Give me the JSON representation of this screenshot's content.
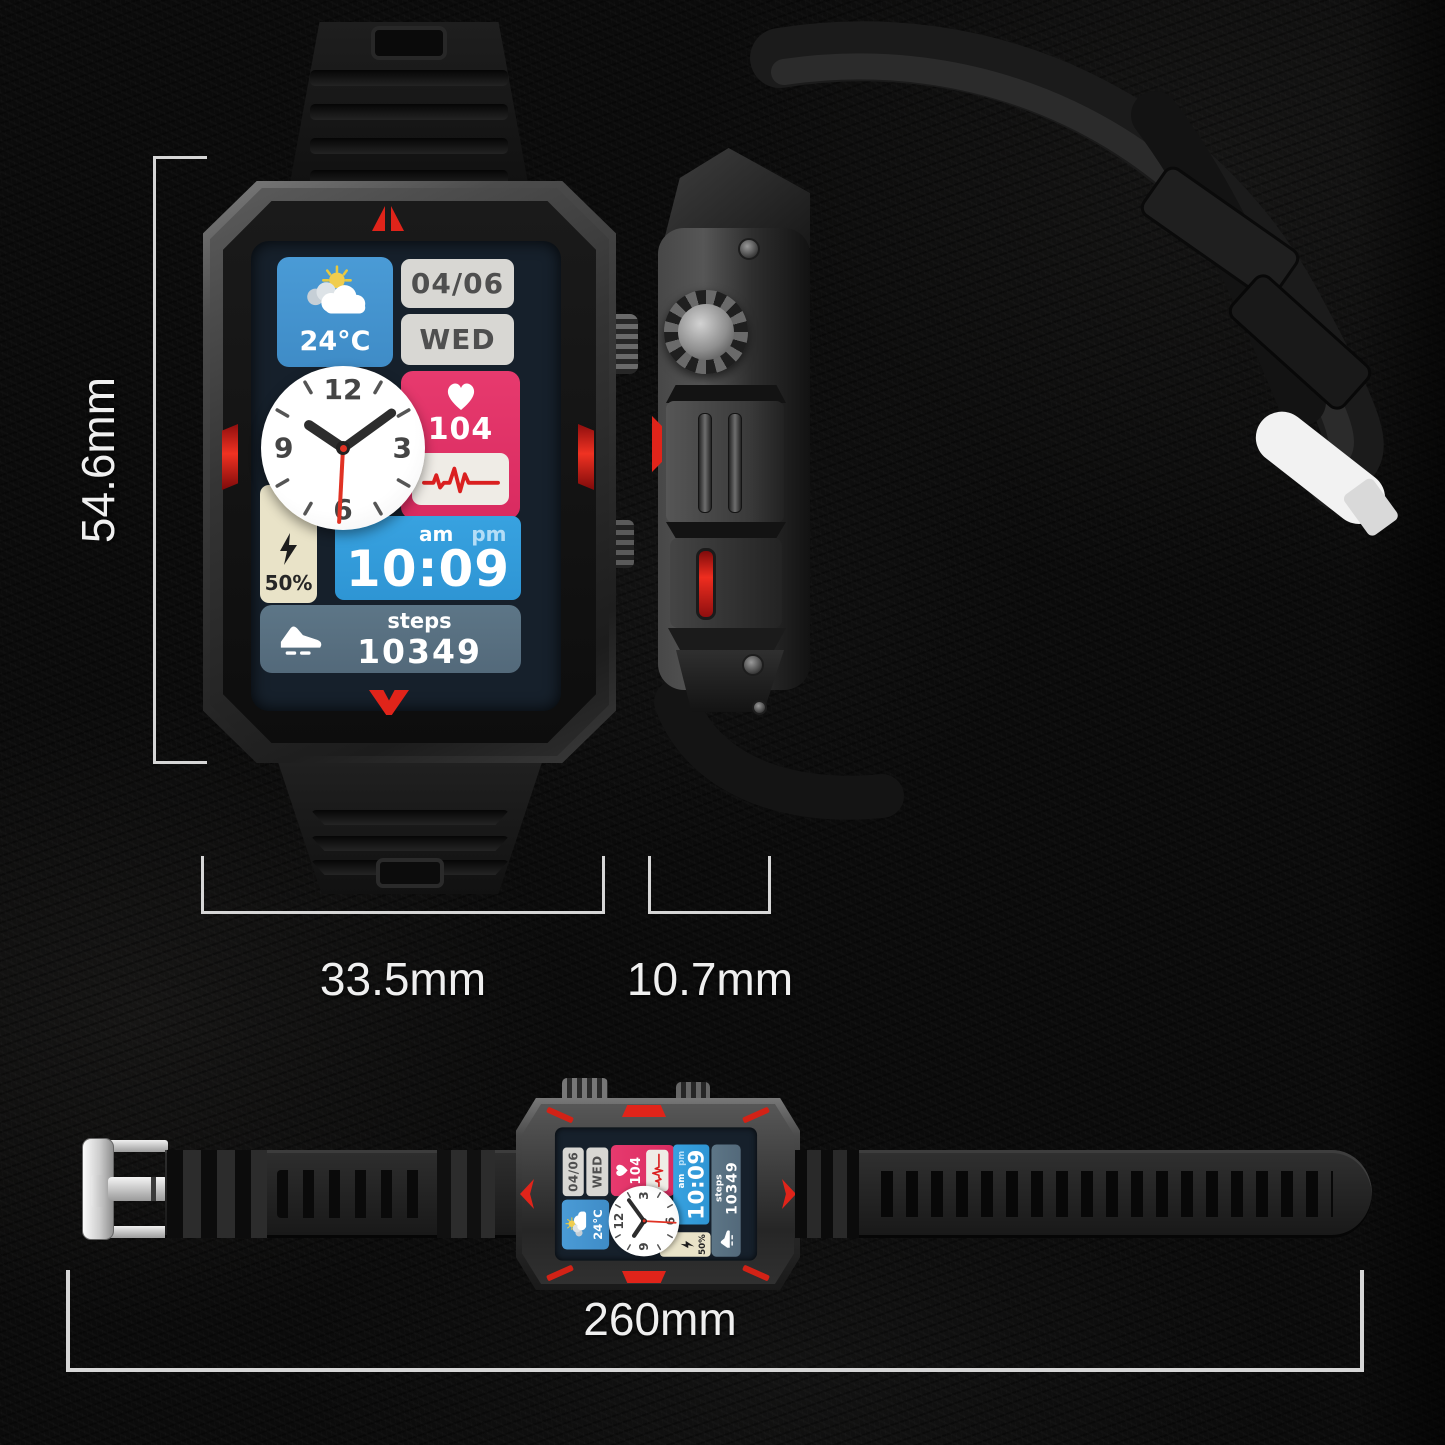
{
  "dimensions": {
    "height": "54.6mm",
    "width": "33.5mm",
    "thickness": "10.7mm",
    "strap_length": "260mm"
  },
  "watch_face": {
    "weather_temp": "24°C",
    "date": "04/06",
    "weekday": "WED",
    "heart_rate": "104",
    "battery_percent": "50%",
    "meridiem_am": "am",
    "meridiem_pm": "pm",
    "time": "10:09",
    "steps_label": "steps",
    "steps_value": "10349",
    "clock": {
      "n12": "12",
      "n3": "3",
      "n6": "6",
      "n9": "9"
    }
  },
  "icons": {
    "weather": "sun-behind-cloud-icon",
    "heart": "heart-icon",
    "ecg": "ecg-line-icon",
    "battery": "lightning-bolt-icon",
    "steps": "running-shoe-icon",
    "clock": "analog-clock",
    "buckle": "metal-buckle"
  },
  "colors": {
    "background": "#0b0b0b",
    "screen_bg": "#16202b",
    "weather_tile": "#4a9bd6",
    "date_tile": "#d8d7d3",
    "date_text": "#4f4f4f",
    "heart_tile": "#e73a6e",
    "ecg_tile": "#efece6",
    "battery_tile": "#e9e3c8",
    "battery_text": "#262626",
    "time_tile": "#38a2e0",
    "steps_tile": "#5d7687",
    "accent_red": "#e0241a",
    "dimension_line": "#d6d6d6"
  }
}
